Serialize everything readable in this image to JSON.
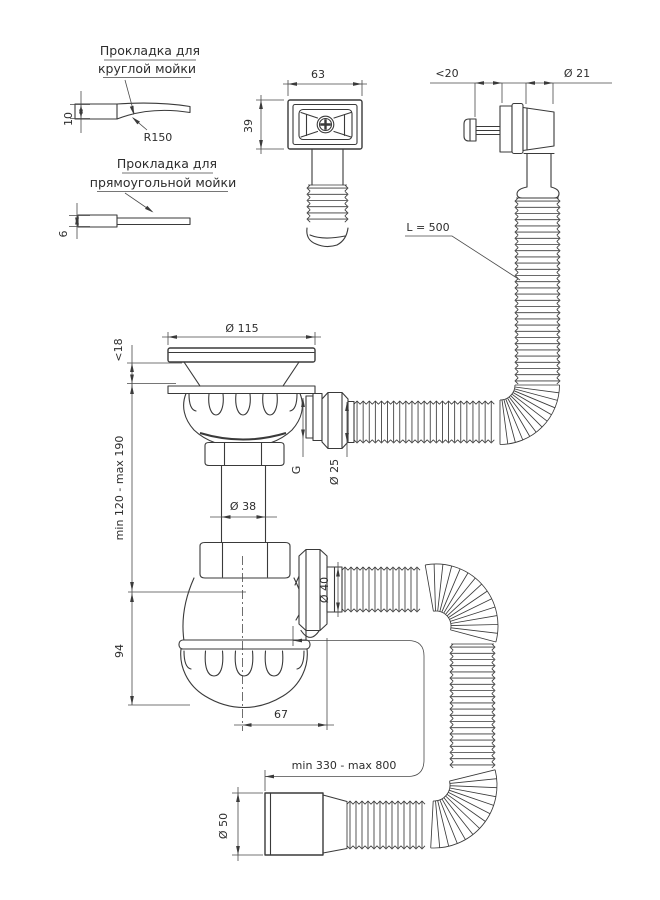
{
  "drawing": {
    "background": "#ffffff",
    "line_color": "#3a3a3a",
    "labels": {
      "gasket_round_line1": "Прокладка для",
      "gasket_round_line2": "круглой мойки",
      "gasket_rect_line1": "Прокладка для",
      "gasket_rect_line2": "прямоугольной мойки",
      "radius": "R150",
      "hose_length": "L = 500"
    },
    "dimensions": {
      "gasket_round_thickness": "10",
      "gasket_rect_thickness": "6",
      "overflow_cover_width": "63",
      "overflow_cover_height": "39",
      "overflow_clamp_range": "<20",
      "overflow_pipe_dia": "Ø 21",
      "strainer_dia": "Ø 115",
      "sink_max_thickness": "<18",
      "height_adjust_range": "min 120 - max 190",
      "tailpipe_dia": "Ø 38",
      "outlet_thread": "G",
      "overflow_hose_dia": "Ø 25",
      "outlet_hose_dia": "Ø 40",
      "body_height": "94",
      "outlet_offset": "67",
      "outlet_hose_range": "min 330 - max 800",
      "end_fitting_dia": "Ø 50"
    }
  }
}
